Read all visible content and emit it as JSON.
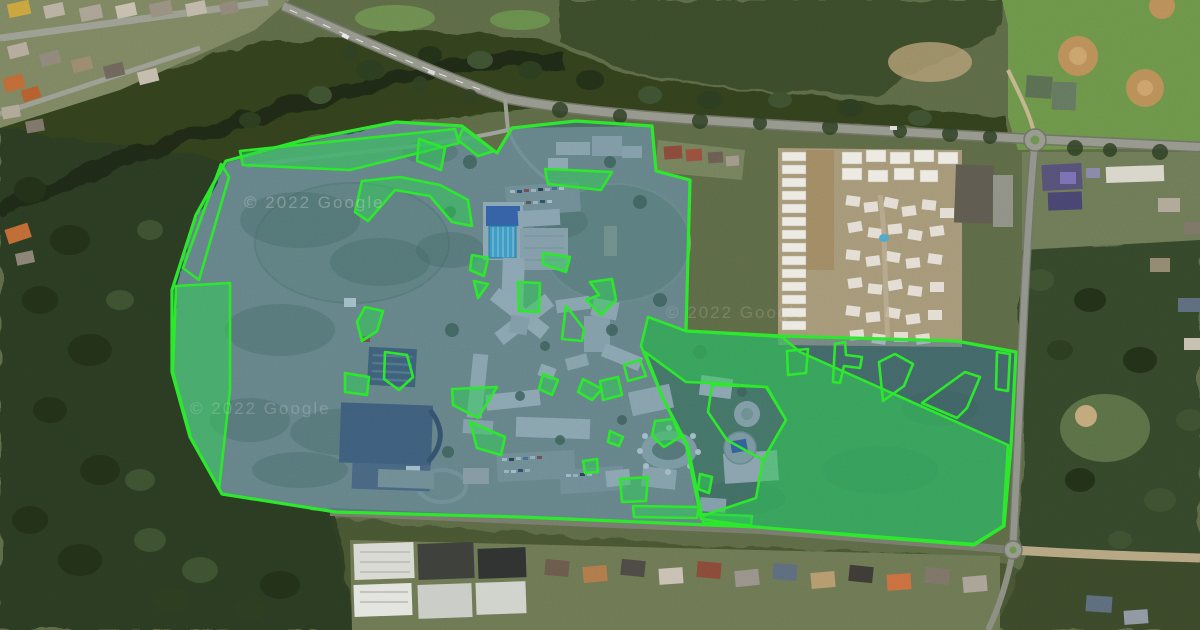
{
  "map": {
    "type": "satellite",
    "description": "Aerial satellite view of a school campus with property boundary and green-space overlay polygons"
  },
  "watermarks": [
    {
      "text": "© 2022 Google",
      "x": 244,
      "y": 208,
      "opacity": 0.3
    },
    {
      "text": "© 2022 Google",
      "x": 190,
      "y": 414,
      "opacity": 0.22
    },
    {
      "text": "© 2022 Google",
      "x": 666,
      "y": 318,
      "opacity": 0.18
    }
  ],
  "overlay": {
    "stroke_color": "#2be82b",
    "parcel_fill": "rgba(36,106,150,0.36)",
    "zone_fill": "rgba(44,208,80,0.5)",
    "boundary": [
      [
        226,
        161
      ],
      [
        300,
        141
      ],
      [
        396,
        122
      ],
      [
        462,
        126
      ],
      [
        497,
        153
      ],
      [
        512,
        128
      ],
      [
        576,
        121
      ],
      [
        652,
        126
      ],
      [
        656,
        171
      ],
      [
        690,
        180
      ],
      [
        686,
        331
      ],
      [
        782,
        336
      ],
      [
        956,
        341
      ],
      [
        1016,
        352
      ],
      [
        1011,
        446
      ],
      [
        1004,
        526
      ],
      [
        974,
        545
      ],
      [
        860,
        536
      ],
      [
        757,
        527
      ],
      [
        520,
        517
      ],
      [
        336,
        512
      ],
      [
        222,
        494
      ],
      [
        190,
        437
      ],
      [
        172,
        372
      ],
      [
        172,
        290
      ],
      [
        196,
        215
      ]
    ],
    "zones": [
      {
        "name": "north-boundary-lawn",
        "points": [
          [
            240,
            151
          ],
          [
            455,
            129
          ],
          [
            459,
            143
          ],
          [
            350,
            170
          ],
          [
            243,
            165
          ]
        ]
      },
      {
        "name": "north-notch-lawn",
        "points": [
          [
            463,
            128
          ],
          [
            494,
            151
          ],
          [
            478,
            156
          ],
          [
            458,
            140
          ]
        ]
      },
      {
        "name": "west-boundary-lawn",
        "points": [
          [
            176,
            286
          ],
          [
            230,
            283
          ],
          [
            230,
            390
          ],
          [
            219,
            489
          ],
          [
            191,
            438
          ],
          [
            173,
            372
          ]
        ]
      },
      {
        "name": "hill-crescent-lawn",
        "points": [
          [
            362,
            181
          ],
          [
            400,
            177
          ],
          [
            440,
            185
          ],
          [
            468,
            200
          ],
          [
            472,
            226
          ],
          [
            452,
            222
          ],
          [
            430,
            196
          ],
          [
            395,
            190
          ],
          [
            368,
            221
          ],
          [
            355,
            212
          ]
        ]
      },
      {
        "name": "carpark-south-lawn",
        "points": [
          [
            545,
            169
          ],
          [
            612,
            172
          ],
          [
            601,
            190
          ],
          [
            548,
            184
          ]
        ]
      },
      {
        "name": "west-gate-lawn",
        "points": [
          [
            419,
            139
          ],
          [
            445,
            148
          ],
          [
            441,
            170
          ],
          [
            417,
            161
          ]
        ]
      },
      {
        "name": "oval-west-lawn",
        "points": [
          [
            518,
            282
          ],
          [
            540,
            283
          ],
          [
            539,
            312
          ],
          [
            519,
            311
          ]
        ]
      },
      {
        "name": "oval-southwest-lawn",
        "points": [
          [
            543,
            253
          ],
          [
            570,
            257
          ],
          [
            566,
            272
          ],
          [
            543,
            264
          ]
        ]
      },
      {
        "name": "pool-east-lawn",
        "points": [
          [
            472,
            255
          ],
          [
            488,
            258
          ],
          [
            484,
            276
          ],
          [
            470,
            270
          ]
        ]
      },
      {
        "name": "pool-south-lawn",
        "points": [
          [
            474,
            281
          ],
          [
            488,
            284
          ],
          [
            478,
            298
          ]
        ]
      },
      {
        "name": "oval-south-crescent",
        "points": [
          [
            590,
            282
          ],
          [
            612,
            279
          ],
          [
            616,
            300
          ],
          [
            601,
            315
          ],
          [
            586,
            300
          ],
          [
            599,
            295
          ]
        ]
      },
      {
        "name": "garden-north-lawn",
        "points": [
          [
            365,
            307
          ],
          [
            383,
            311
          ],
          [
            377,
            331
          ],
          [
            362,
            341
          ],
          [
            357,
            322
          ]
        ]
      },
      {
        "name": "garden-west-lawn",
        "points": [
          [
            345,
            373
          ],
          [
            369,
            377
          ],
          [
            367,
            395
          ],
          [
            345,
            392
          ]
        ]
      },
      {
        "name": "quad-northwest-lawn",
        "points": [
          [
            452,
            389
          ],
          [
            497,
            387
          ],
          [
            478,
            418
          ],
          [
            453,
            405
          ]
        ]
      },
      {
        "name": "quad-southwest-lawn",
        "points": [
          [
            470,
            422
          ],
          [
            505,
            437
          ],
          [
            501,
            455
          ],
          [
            477,
            448
          ]
        ]
      },
      {
        "name": "quad-center-lawn",
        "points": [
          [
            543,
            374
          ],
          [
            558,
            380
          ],
          [
            552,
            395
          ],
          [
            539,
            389
          ]
        ]
      },
      {
        "name": "quad-east-lawn",
        "points": [
          [
            583,
            379
          ],
          [
            602,
            389
          ],
          [
            592,
            400
          ],
          [
            578,
            392
          ]
        ]
      },
      {
        "name": "south-small-lawn-1",
        "points": [
          [
            610,
            431
          ],
          [
            623,
            437
          ],
          [
            619,
            446
          ],
          [
            608,
            442
          ]
        ]
      },
      {
        "name": "south-small-lawn-2",
        "points": [
          [
            583,
            461
          ],
          [
            597,
            459
          ],
          [
            598,
            472
          ],
          [
            585,
            473
          ]
        ]
      },
      {
        "name": "south-lawn-3",
        "points": [
          [
            620,
            479
          ],
          [
            648,
            477
          ],
          [
            646,
            501
          ],
          [
            622,
            502
          ]
        ]
      },
      {
        "name": "south-road-strip-1",
        "points": [
          [
            633,
            506
          ],
          [
            699,
            507
          ],
          [
            697,
            518
          ],
          [
            634,
            517
          ]
        ]
      },
      {
        "name": "south-road-strip-2",
        "points": [
          [
            704,
            514
          ],
          [
            752,
            516
          ],
          [
            751,
            525
          ],
          [
            703,
            523
          ]
        ]
      },
      {
        "name": "courtyard-north-lawn",
        "points": [
          [
            655,
            421
          ],
          [
            673,
            419
          ],
          [
            680,
            437
          ],
          [
            664,
            447
          ],
          [
            652,
            436
          ]
        ]
      },
      {
        "name": "courtyard-west-lawn",
        "points": [
          [
            600,
            381
          ],
          [
            618,
            377
          ],
          [
            622,
            395
          ],
          [
            603,
            400
          ]
        ]
      },
      {
        "name": "courtyard-south-lawn",
        "points": [
          [
            700,
            474
          ],
          [
            712,
            477
          ],
          [
            709,
            493
          ],
          [
            698,
            489
          ]
        ]
      },
      {
        "name": "east-paddock",
        "points": [
          [
            648,
            317
          ],
          [
            686,
            331
          ],
          [
            782,
            337
          ],
          [
            800,
            352
          ],
          [
            1008,
            445
          ],
          [
            1003,
            526
          ],
          [
            974,
            544
          ],
          [
            860,
            535
          ],
          [
            757,
            527
          ],
          [
            701,
            519
          ],
          [
            686,
            445
          ],
          [
            663,
            399
          ],
          [
            641,
            346
          ]
        ],
        "hole": [
          [
            645,
            352
          ],
          [
            686,
            382
          ],
          [
            712,
            383
          ],
          [
            766,
            387
          ],
          [
            786,
            420
          ],
          [
            763,
            460
          ],
          [
            756,
            498
          ],
          [
            702,
            516
          ],
          [
            688,
            446
          ],
          [
            664,
            400
          ]
        ]
      }
    ],
    "outlines": [
      {
        "name": "west-edge-triangle",
        "points": [
          [
            183,
            268
          ],
          [
            221,
            164
          ],
          [
            229,
            177
          ],
          [
            199,
            280
          ]
        ]
      },
      {
        "name": "garden-pentagon",
        "points": [
          [
            385,
            352
          ],
          [
            407,
            355
          ],
          [
            413,
            377
          ],
          [
            399,
            390
          ],
          [
            384,
            379
          ]
        ]
      },
      {
        "name": "east-cluster-outline",
        "points": [
          [
            712,
            385
          ],
          [
            767,
            387
          ],
          [
            786,
            420
          ],
          [
            763,
            460
          ],
          [
            727,
            440
          ],
          [
            708,
            412
          ]
        ]
      },
      {
        "name": "paddock-outline-1",
        "points": [
          [
            787,
            351
          ],
          [
            808,
            349
          ],
          [
            806,
            373
          ],
          [
            788,
            375
          ]
        ]
      },
      {
        "name": "paddock-outline-t",
        "points": [
          [
            835,
            344
          ],
          [
            845,
            342
          ],
          [
            846,
            355
          ],
          [
            862,
            357
          ],
          [
            860,
            368
          ],
          [
            844,
            366
          ],
          [
            840,
            383
          ],
          [
            833,
            382
          ]
        ]
      },
      {
        "name": "paddock-outline-2",
        "points": [
          [
            879,
            362
          ],
          [
            895,
            354
          ],
          [
            913,
            364
          ],
          [
            904,
            386
          ],
          [
            883,
            401
          ]
        ]
      },
      {
        "name": "paddock-outline-3",
        "points": [
          [
            922,
            403
          ],
          [
            965,
            372
          ],
          [
            980,
            377
          ],
          [
            967,
            408
          ],
          [
            957,
            418
          ]
        ]
      },
      {
        "name": "paddock-outline-4",
        "points": [
          [
            997,
            352
          ],
          [
            1010,
            354
          ],
          [
            1008,
            391
          ],
          [
            996,
            389
          ]
        ]
      },
      {
        "name": "oval-triangle-outline",
        "points": [
          [
            566,
            306
          ],
          [
            584,
            329
          ],
          [
            582,
            341
          ],
          [
            562,
            339
          ]
        ]
      },
      {
        "name": "small-outline-quad",
        "points": [
          [
            624,
            365
          ],
          [
            640,
            360
          ],
          [
            646,
            376
          ],
          [
            628,
            381
          ]
        ]
      }
    ]
  }
}
